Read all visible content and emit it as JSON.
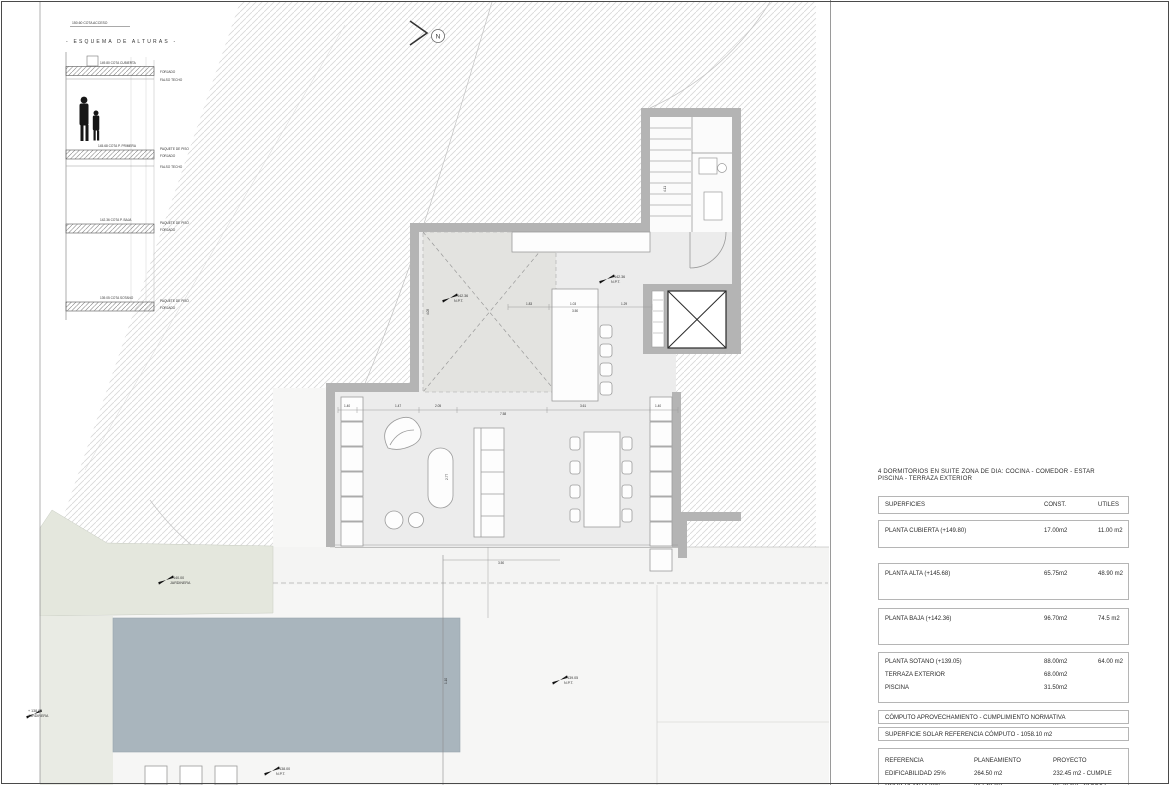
{
  "north": {
    "label": "N"
  },
  "elevation": {
    "access_label": "150.60 COTA ACCESO",
    "title": "- ESQUEMA DE ALTURAS -",
    "levels": [
      {
        "label": "149.80 COTA CUBIERTA",
        "side": [
          "FORJADO",
          "FALSO TECHO"
        ]
      },
      {
        "label": "145.68 COTA P. PRIMERA",
        "side": [
          "PAQUETE DE PISO",
          "FORJADO",
          "FALSO TECHO"
        ]
      },
      {
        "label": "142.36 COTA P. BAJA",
        "side": [
          "PAQUETE DE PISO",
          "FORJADO"
        ]
      },
      {
        "label": "139.05 COTA SOTANO",
        "side": [
          "PAQUETE DE PISO",
          "FORJADO"
        ]
      }
    ]
  },
  "plan": {
    "markers": [
      {
        "value": "+ 142.36",
        "sub": "N.P.T."
      },
      {
        "value": "+ 142.36",
        "sub": "N.P.T."
      },
      {
        "value": "+ 139.05",
        "sub": "N.P.T."
      },
      {
        "value": "+ 140.00",
        "sub": "JARDINERA"
      },
      {
        "value": "+ 138.00",
        "sub": "JARDINERA"
      },
      {
        "value": "+ 138.00",
        "sub": "N.P.T."
      }
    ],
    "dims": [
      {
        "v": "1.40"
      },
      {
        "v": "1.47"
      },
      {
        "v": "2.05"
      },
      {
        "v": "3.61"
      },
      {
        "v": "1.40"
      },
      {
        "v": "7.58"
      },
      {
        "v": "1.83"
      },
      {
        "v": "1.03"
      },
      {
        "v": "1.29"
      },
      {
        "v": "3.50"
      },
      {
        "v": "3.50"
      },
      {
        "v": "4.11"
      },
      {
        "v": "2.77"
      },
      {
        "v": "4.05"
      },
      {
        "v": "1.10"
      }
    ]
  },
  "summary": {
    "program_line1": "4 DORMITORIOS EN SUITE ZONA DE DIA: COCINA - COMEDOR - ESTAR",
    "program_line2": "PISCINA - TERRAZA EXTERIOR",
    "surfaces": {
      "header": {
        "label": "SUPERFICIES",
        "const": "CONST.",
        "utiles": "UTILES"
      },
      "rows": [
        {
          "label": "PLANTA CUBIERTA (+149.80)",
          "const": "17.00m2",
          "utiles": "11.00 m2"
        },
        {
          "label": "PLANTA ALTA (+145.68)",
          "const": "65.75m2",
          "utiles": "48.90 m2"
        },
        {
          "label": "PLANTA BAJA (+142.36)",
          "const": "96.70m2",
          "utiles": "74.5 m2"
        },
        {
          "label": "PLANTA SOTANO (+139.05)",
          "const": "88.00m2",
          "utiles": "64.00 m2",
          "extra": [
            {
              "label": "TERRAZA EXTERIOR",
              "const": "68.00m2"
            },
            {
              "label": "PISCINA",
              "const": "31.50m2"
            }
          ]
        }
      ]
    },
    "computo_title": "CÓMPUTO APROVECHAMIENTO - CUMPLIMIENTO NORMATIVA",
    "computo_solar": "SUPERFICIE SOLAR REFERENCIA CÓMPUTO - 1058.10 m2",
    "reference": {
      "headers": [
        "REFERENCIA",
        "PLANEAMIENTO",
        "PROYECTO"
      ],
      "rows": [
        {
          "label": "EDIFICABILIDAD 25%",
          "plan": "264.50 m2",
          "proj": "232.45 m2 - CUMPLE"
        },
        {
          "label": "OCUP. PLANTA 30%",
          "plan": "317.40 m2",
          "proj": "96.70 m2 - CUMPLE"
        }
      ]
    }
  },
  "colors": {
    "wall": "#b4b4b4",
    "pool": "#a9b5bd",
    "floor": "#ececec",
    "jardinera": "#e4e7dd",
    "hatch": "#d8d8d8"
  }
}
